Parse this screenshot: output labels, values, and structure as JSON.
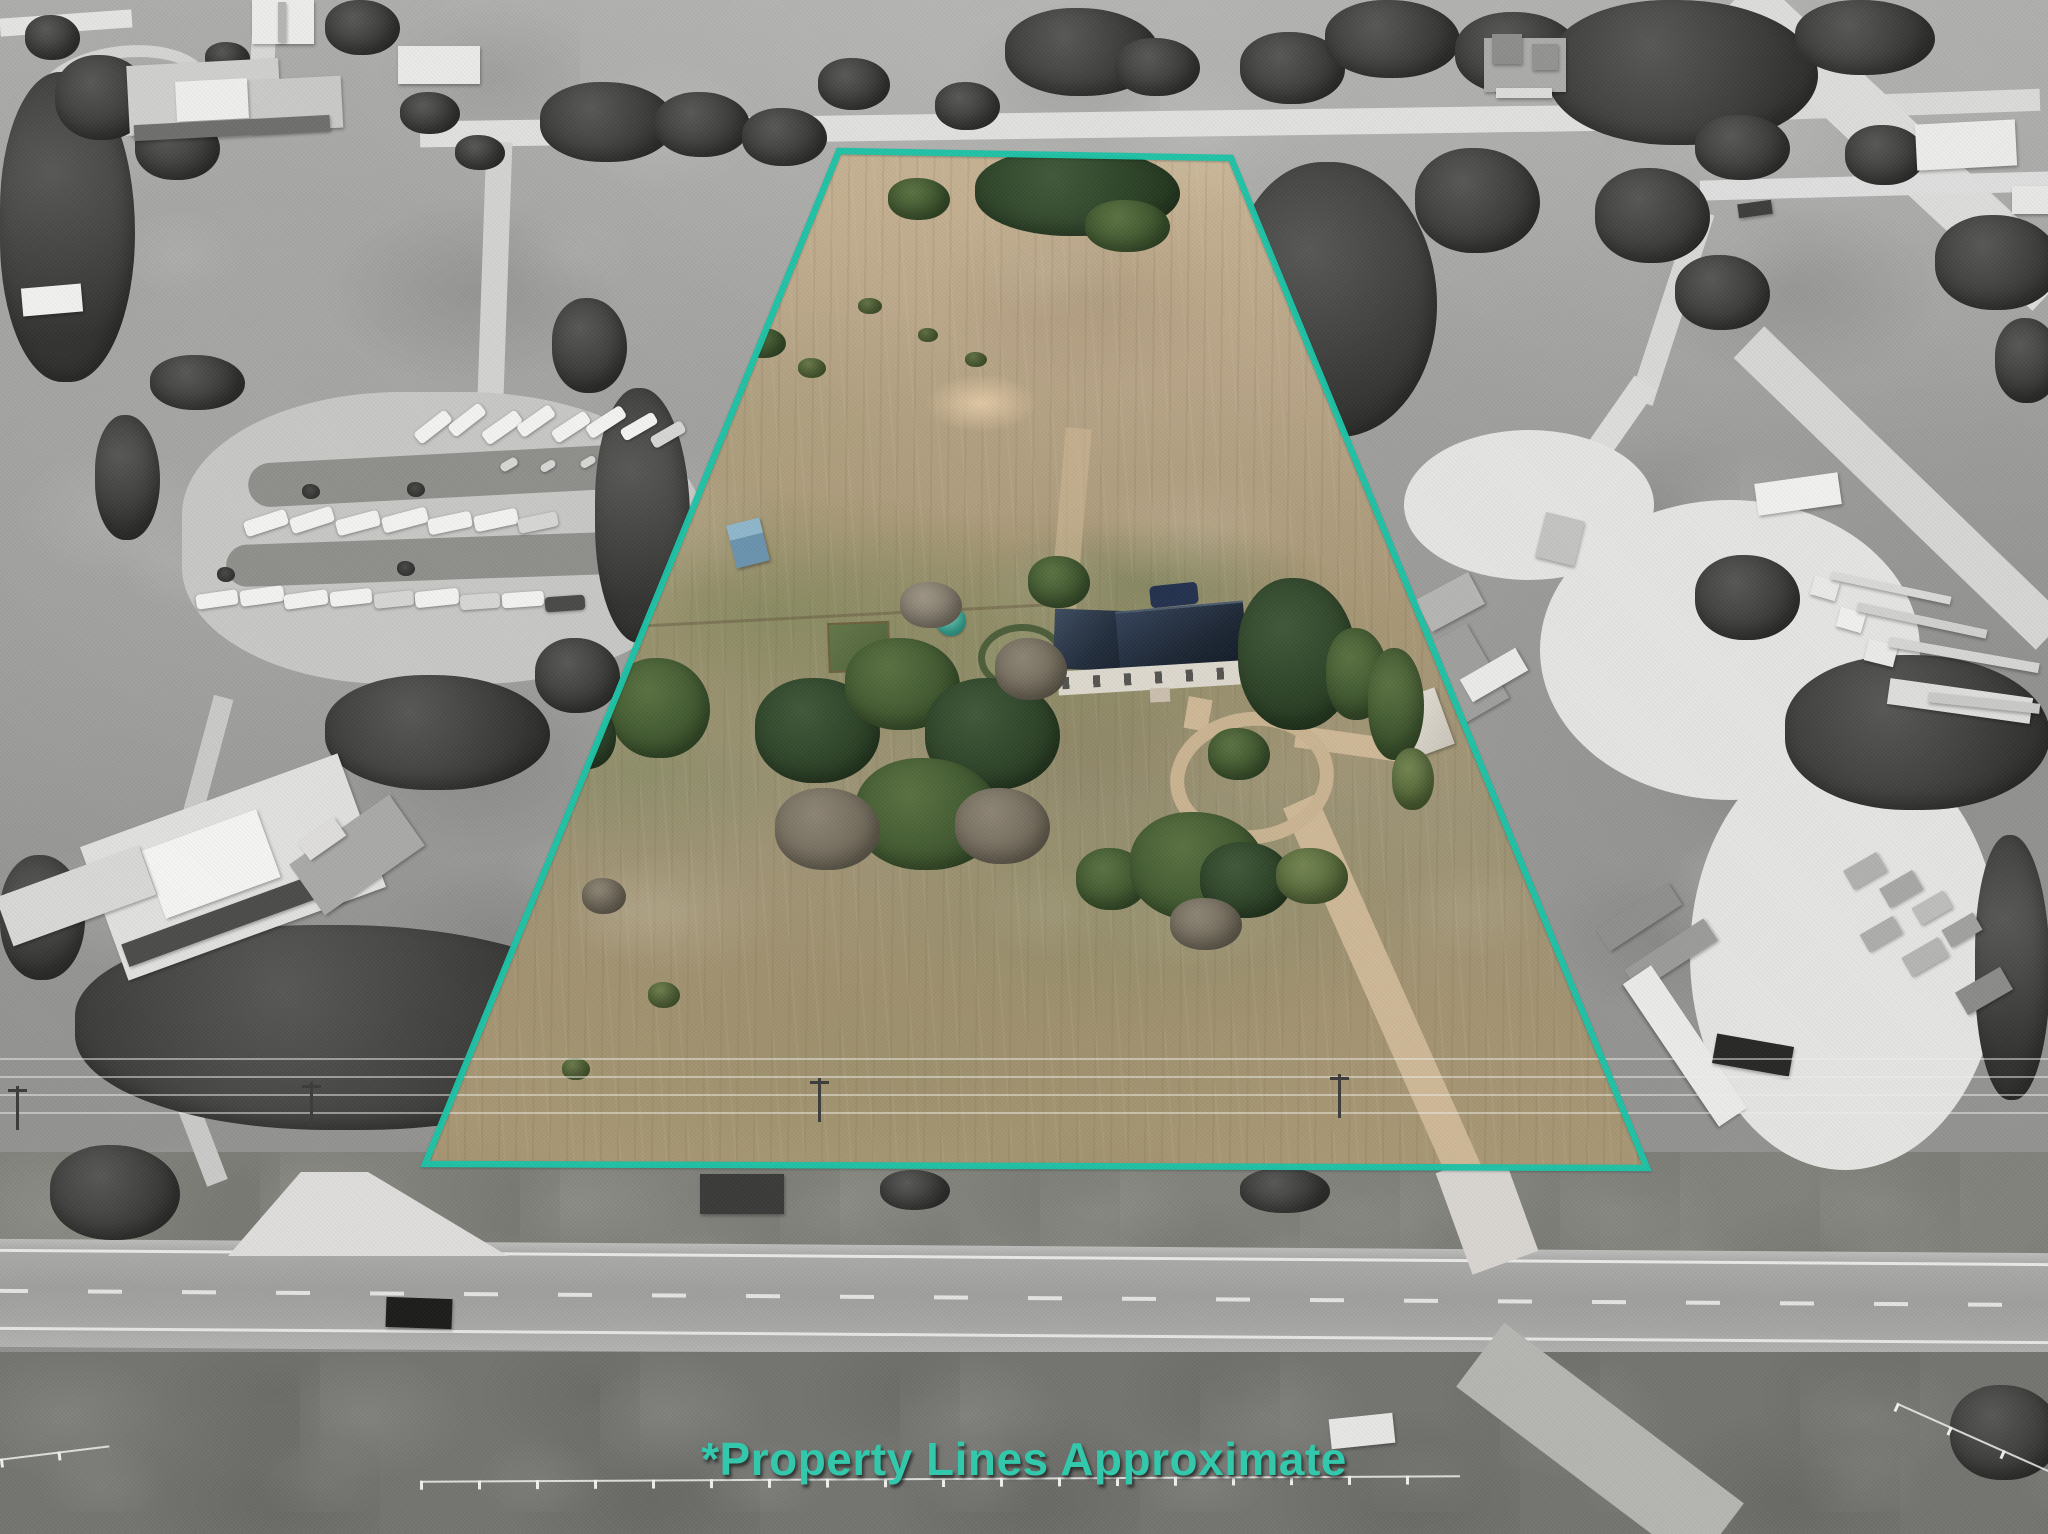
{
  "photo": {
    "caption": "*Property Lines Approximate",
    "style": "aerial drone real-estate photo; surroundings desaturated to grayscale, highlighted parcel shown in color"
  },
  "colors": {
    "boundary_teal": "#1dc3a7",
    "caption_teal": "#33c7ab",
    "parcel_field_tan": "#b3a184",
    "house_roof_navy": "#232f3f",
    "surroundings_gray": "#9a9a98"
  },
  "features": [
    "highlighted property parcel (trapezoid)",
    "teal property boundary outline",
    "single-story house with dark roof",
    "circular gravel driveway loop",
    "long dirt driveway to highway",
    "gazebo with teal roof",
    "garden plot",
    "round pen",
    "blue shed and white shed",
    "scattered green trees",
    "RV park to the west",
    "commercial truck yard to the east",
    "rural homes to the north",
    "two-lane highway along the south",
    "power lines along highway",
    "white fence line",
    "dirt side roads"
  ]
}
